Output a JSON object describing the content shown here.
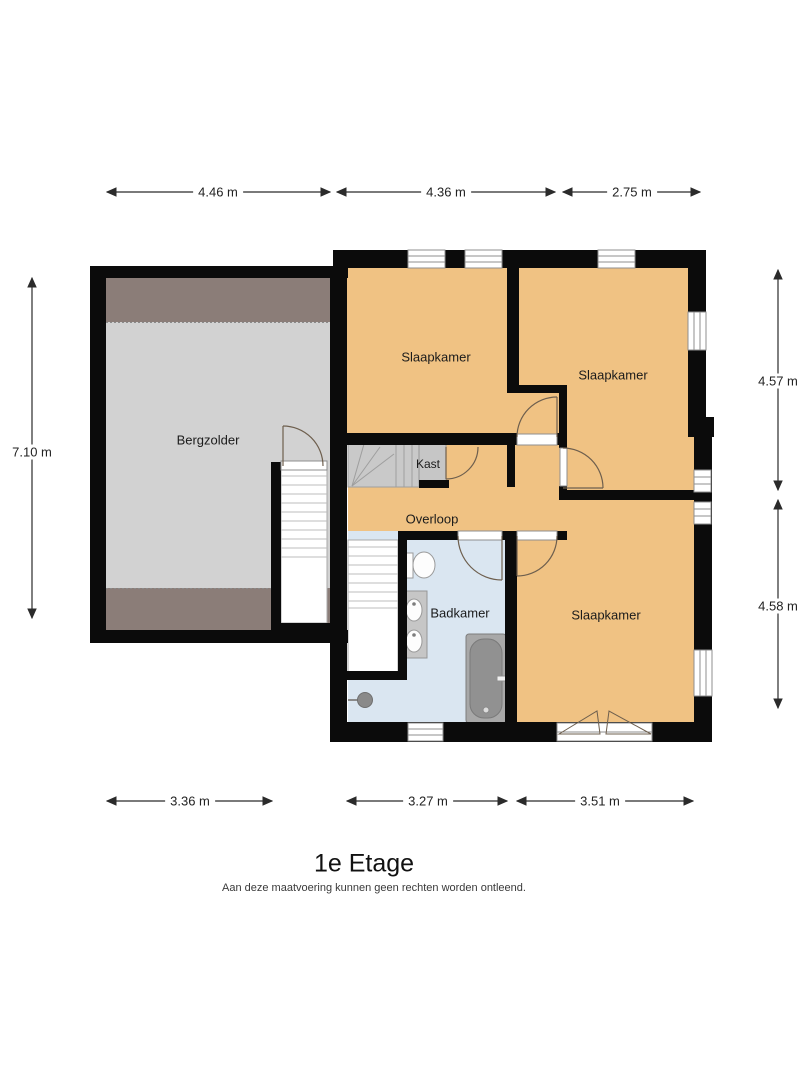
{
  "title": "1e Etage",
  "disclaimer": "Aan deze maatvoering kunnen geen rechten worden ontleend.",
  "rooms": {
    "bergzolder": {
      "label": "Bergzolder"
    },
    "slaapkamer_1": {
      "label": "Slaapkamer"
    },
    "slaapkamer_2": {
      "label": "Slaapkamer"
    },
    "slaapkamer_3": {
      "label": "Slaapkamer"
    },
    "kast": {
      "label": "Kast"
    },
    "overloop": {
      "label": "Overloop"
    },
    "badkamer": {
      "label": "Badkamer"
    }
  },
  "dimensions": {
    "top": [
      {
        "label": "4.46 m"
      },
      {
        "label": "4.36 m"
      },
      {
        "label": "2.75 m"
      }
    ],
    "bottom": [
      {
        "label": "3.36 m"
      },
      {
        "label": "3.27 m"
      },
      {
        "label": "3.51 m"
      }
    ],
    "left": [
      {
        "label": "7.10 m"
      }
    ],
    "right": [
      {
        "label": "4.57 m"
      },
      {
        "label": "4.58 m"
      }
    ]
  },
  "colors": {
    "wall": "#0b0b0b",
    "floor_orange": "#f0c283",
    "floor_blue": "#dae6f1",
    "floor_gray": "#d2d2d2",
    "attic_band": "#8b7d78",
    "stair_gray": "#c9c9c9",
    "door_arc": "#6e5f4e",
    "dim_text": "#222222"
  }
}
